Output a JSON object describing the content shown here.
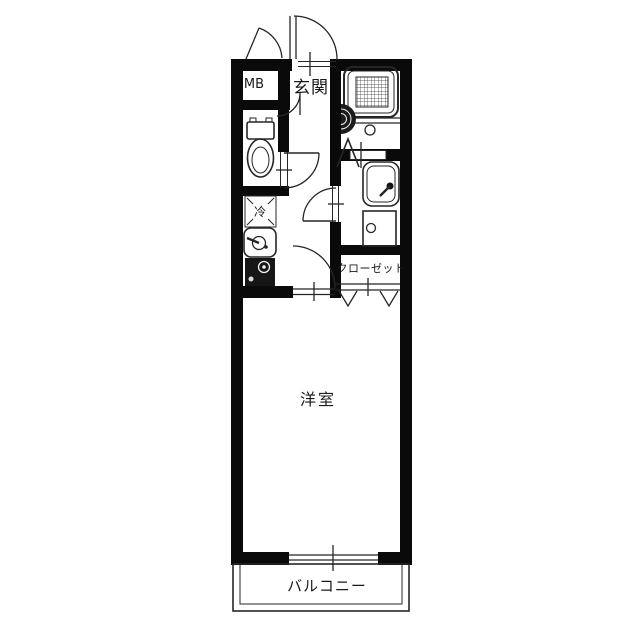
{
  "colors": {
    "background": "#ffffff",
    "walls": "#0a0a0a",
    "lines": "#262626",
    "text": "#1a1a1a"
  },
  "labels": {
    "meter_box": "MB",
    "entrance": "玄関",
    "refrigerator_space": "冷",
    "closet": "クローゼット",
    "western_room": "洋室",
    "balcony": "バルコニー"
  }
}
